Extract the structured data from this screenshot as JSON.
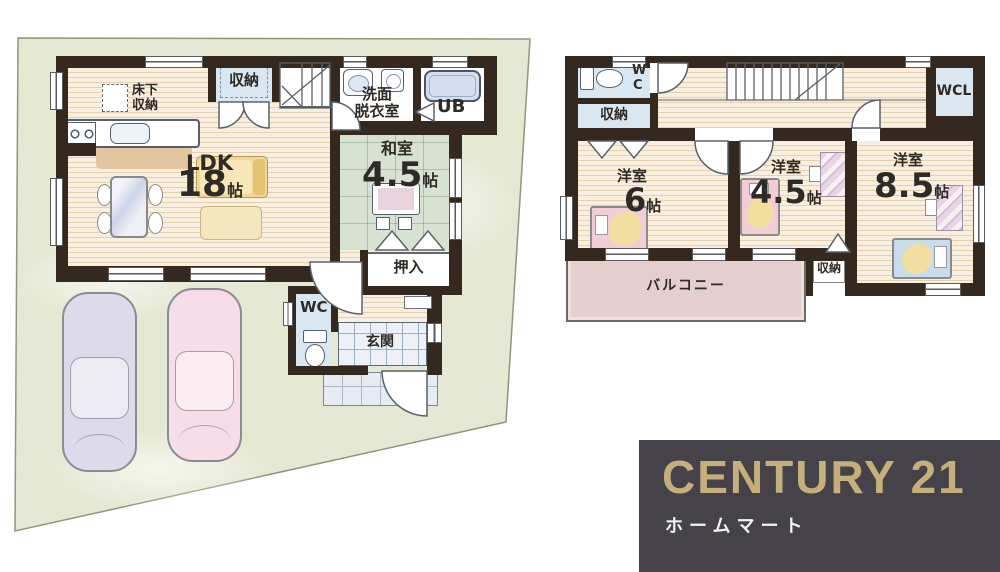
{
  "floor1": {
    "labels": {
      "storage_top": "収納",
      "underfloor_line1": "床下",
      "underfloor_line2": "収納",
      "washroom_line1": "洗面",
      "washroom_line2": "脱衣室",
      "unit_bath": "UB",
      "ldk_name": "LDK",
      "ldk_num": "18",
      "ldk_unit": "帖",
      "washitsu_name": "和室",
      "washitsu_num": "4.5",
      "washitsu_unit": "帖",
      "oshiire": "押入",
      "wc": "WC",
      "genkan": "玄関"
    }
  },
  "floor2": {
    "labels": {
      "wc_line1": "W",
      "wc_line2": "C",
      "storage_a": "収納",
      "wcl": "WCL",
      "room6_name": "洋室",
      "room6_num": "6",
      "room6_unit": "帖",
      "room45_name": "洋室",
      "room45_num": "4.5",
      "room45_unit": "帖",
      "room85_name": "洋室",
      "room85_num": "8.5",
      "room85_unit": "帖",
      "balcony": "バルコニー",
      "storage_b": "収納"
    }
  },
  "logo": {
    "brand": "CENTURY 21",
    "sub": "ホームマート"
  },
  "colors": {
    "wall": "#35291f",
    "site_green": "#e5e9d3",
    "wood_floor": "#f8efe0",
    "tatami_green": "#d8e2d3",
    "balcony_pink": "#e5cfce",
    "closet_blue": "#d9e7f3",
    "logo_gold": "#c5b07c",
    "logo_bg": "#454349",
    "car_blue": "#dcdaeb",
    "car_pink": "#f7dde8"
  }
}
